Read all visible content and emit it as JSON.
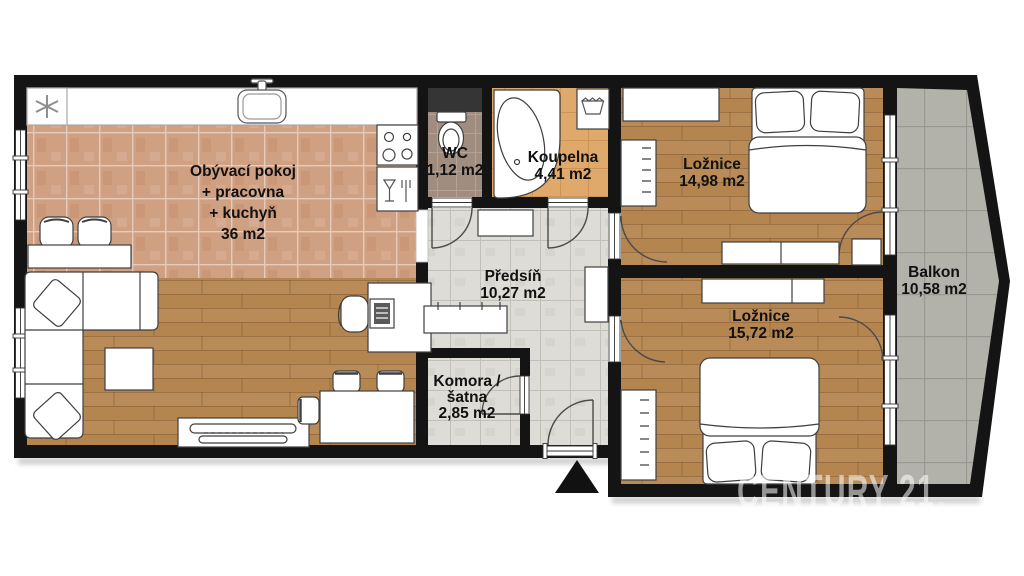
{
  "plan_title": "Floor plan",
  "rooms": {
    "living": {
      "name": "Obývací pokoj",
      "line2": "+ pracovna",
      "line3": "+ kuchyň",
      "area": "36 m2"
    },
    "wc": {
      "name": "WC",
      "area": "1,12 m2"
    },
    "bathroom": {
      "name": "Koupelna",
      "area": "4,41 m2"
    },
    "bedroom1": {
      "name": "Ložnice",
      "area": "14,98 m2"
    },
    "hallway": {
      "name": "Předsíň",
      "area": "10,27 m2"
    },
    "bedroom2": {
      "name": "Ložnice",
      "area": "15,72 m2"
    },
    "pantry": {
      "line1": "Komora /",
      "line2": "šatna",
      "area": "2,85 m2"
    },
    "balcony": {
      "name": "Balkon",
      "area": "10,58 m2"
    }
  },
  "watermark": {
    "brand": "CENTURY 21",
    "registered": "®"
  },
  "colors": {
    "wall": "#141414",
    "wood_floor": "#b5854f",
    "kitchen_tile": "#d0a083",
    "bath_tile": "#e0a96c",
    "wc_floor": "#a18d80",
    "hall_tile": "#dddcd6",
    "balcony_tile": "#b2b1aa",
    "label_text": "#111111",
    "watermark": "rgba(255,255,255,0.55)"
  }
}
